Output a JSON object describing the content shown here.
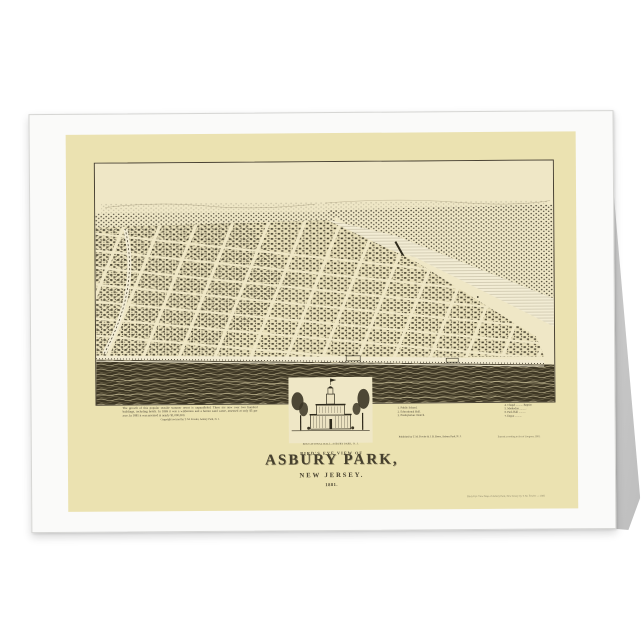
{
  "card": {
    "title_block": {
      "kicker": "BIRD'S EYE VIEW OF",
      "title": "ASBURY PARK,",
      "subtitle": "NEW JERSEY.",
      "year": "1881."
    },
    "description": {
      "text": "The growth of this popular seaside summer resort is unparalleled. There are now over two hundred buildings, including hotels. In 1869 it was a wilderness and a barren sand waste, assessed at only $5 per acre. In 1881 it was assessed at nearly $1,000,000.",
      "credit": "Copyright secured by T. M. Fowler, Asbury Park, N. J."
    },
    "vignette": {
      "caption": "EDUCATIONAL HALL, ASBURY PARK, N. J."
    },
    "legend": {
      "left": [
        "1. Public School.",
        "2. Educational Hall.",
        "3. Presbyterian Church."
      ],
      "left_footer": "Published by T. M. Fowler & J. B. Beers, Asbury Park, N. J.",
      "right": [
        "4. Chapel .......... Baptist",
        "5. Methodist ..........",
        "6. Park Hall ..........",
        "7. Depot .........."
      ],
      "right_footer": "Entered according to Act of Congress, 1881."
    },
    "fine_print": "Birds Eye View Map of Asbury Park, New Jersey by T. M. Fowler — 1881"
  },
  "colors": {
    "page_background": "#ffffff",
    "card_front": "#fafaf9",
    "cream_panel": "#ebe2b1",
    "map_paper": "#efe7c6",
    "ink": "#332e1f",
    "ocean": "#3d3624"
  }
}
